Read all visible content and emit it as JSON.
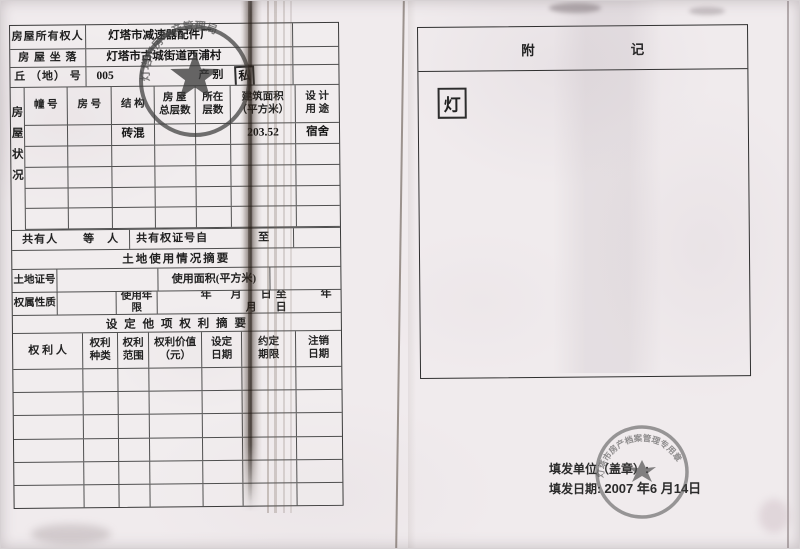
{
  "doc": {
    "left_form": {
      "owner_label": "房屋所有权人",
      "owner_value": "灯塔市减速器配件厂",
      "address_label": "房 屋 坐 落",
      "address_value": "灯塔市古城街道西浦村",
      "plot_label": "丘 （地） 号",
      "plot_value": "005",
      "category_label": "产别",
      "category_value": "私",
      "housing": {
        "side_label": "房屋状况",
        "columns": [
          {
            "l1": "幢 号",
            "l2": ""
          },
          {
            "l1": "房 号",
            "l2": ""
          },
          {
            "l1": "结 构",
            "l2": ""
          },
          {
            "l1": "房 屋",
            "l2": "总层数"
          },
          {
            "l1": "所在",
            "l2": "层数"
          },
          {
            "l1": "建筑面积",
            "l2": "（平方米）"
          },
          {
            "l1": "设 计",
            "l2": "用 途"
          }
        ],
        "row1": {
          "structure": "砖混",
          "area": "203.52",
          "use": "宿舍"
        }
      },
      "co_owner": {
        "label": "共有人",
        "suffix": "等　人",
        "cert_label": "共有权证号自",
        "to_label": "至"
      },
      "land_title": "土地使用情况摘要",
      "land_cert_label": "土地证号",
      "land_area_label": "使用面积(平方米)",
      "tenure_label": "权属性质",
      "years_label": "使用年限",
      "date_range": "年　月　日至　　年　月　日",
      "rights_title": "设 定 他 项 权 利 摘 要",
      "rights_columns": [
        {
          "l1": "权 利 人",
          "l2": ""
        },
        {
          "l1": "权利",
          "l2": "种类"
        },
        {
          "l1": "权利",
          "l2": "范围"
        },
        {
          "l1": "权利价值",
          "l2": "（元）"
        },
        {
          "l1": "设定",
          "l2": "日期"
        },
        {
          "l1": "约定",
          "l2": "期限"
        },
        {
          "l1": "注销",
          "l2": "日期"
        }
      ]
    },
    "right_page": {
      "appendix_left": "附",
      "appendix_right": "记",
      "stamp_char": "灯",
      "issuer_label": "填发单位（盖章）:",
      "date_label": "填发日期:",
      "date_value": "2007 年6 月14日"
    },
    "stamps": {
      "left_arc_text": "灯塔市房地产管理局",
      "right_arc_text": "灯塔市房产档案管理专用章"
    }
  }
}
